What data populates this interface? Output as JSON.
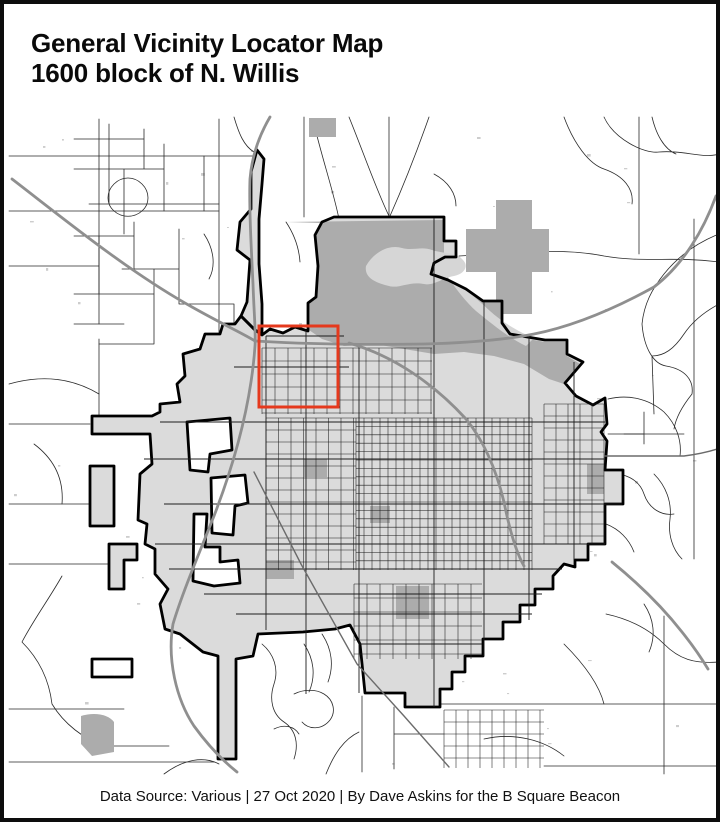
{
  "page": {
    "title_line1": "General Vicinity Locator Map",
    "title_line2": "1600 block of N. Willis"
  },
  "footer": {
    "credit": "Data Source: Various | 27 Oct 2020 | By Dave Askins for the B Square Beacon"
  },
  "map": {
    "kind": "general-vicinity-locator-map",
    "highlight": {
      "x": 255,
      "y": 322,
      "width": 79,
      "height": 81,
      "stroke": "#e5391d",
      "stroke_width": 3
    },
    "colors": {
      "background": "#ffffff",
      "city_fill": "#dbdbdb",
      "township_fill": "#acacac",
      "lake_fill": "#d6d6d6",
      "boundary": "#000000",
      "road_thin": "#2a2a2a",
      "road_urban": "#1c1c1c",
      "road_medium": "#6b6b6b",
      "highway": "#8f8f8f",
      "speckle": "#cdcdcd",
      "enclave_fill": "#ffffff",
      "highlight": "#e5391d"
    }
  }
}
